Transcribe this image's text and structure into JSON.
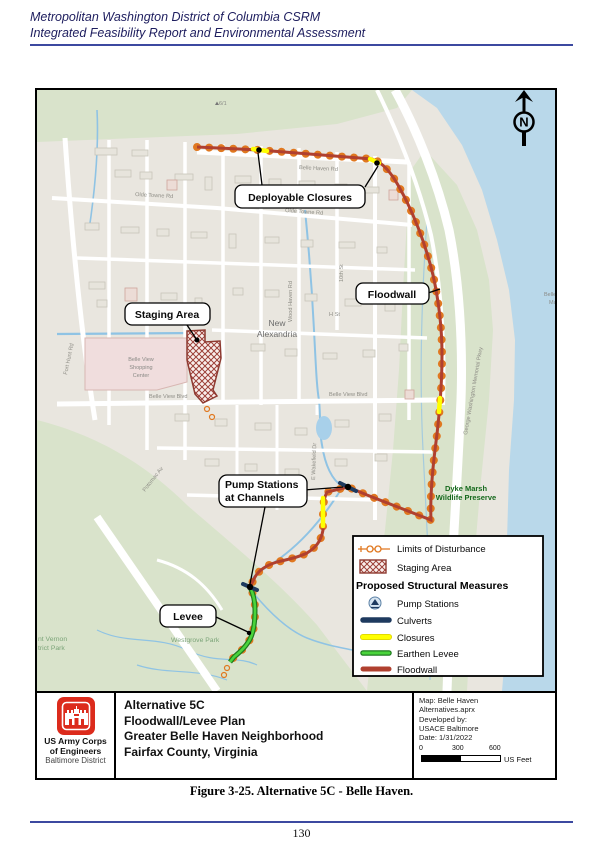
{
  "header": {
    "line1": "Metropolitan Washington District of Columbia CSRM",
    "line2": "Integrated Feasibility Report and Environmental Assessment"
  },
  "map": {
    "north_letter": "N",
    "spot_marker": "6/1",
    "callout_deployable": "Deployable Closures",
    "callout_floodwall": "Floodwall",
    "callout_staging": "Staging Area",
    "callout_pump_line1": "Pump Stations",
    "callout_pump_line2": "at Channels",
    "callout_levee": "Levee",
    "place_new": "New",
    "place_alexandria": "Alexandria",
    "place_shopping_l1": "Belle View",
    "place_shopping_l2": "Shopping",
    "place_shopping_l3": "Center",
    "place_dyke_l1": "Dyke Marsh",
    "place_dyke_l2": "Wildlife Preserve",
    "place_westgrove": "Westgrove Park",
    "place_mtvernon_l1": "nt Vernon",
    "place_mtvernon_l2": "trict Park",
    "place_marina_l1": "Belle",
    "place_marina_l2": "Ma",
    "st_belle_haven": "Belle Haven Rd",
    "st_olde_towne_w": "Olde Towne Rd",
    "st_olde_towne_e": "Olde Towne Rd",
    "st_belle_view_w": "Belle View Blvd",
    "st_belle_view_e": "Belle View Blvd",
    "st_fort_hunt": "Fort Hunt Rd",
    "st_gw_pkwy": "George Washington Memorial Pkwy",
    "st_wood_haven": "Wood Haven Rd",
    "st_10th": "10th St",
    "st_7th": "7th St",
    "st_h": "H St",
    "st_wakefield": "E Wakefield Dr",
    "st_potomac": "Potomac Av"
  },
  "legend": {
    "lod": "Limits of Disturbance",
    "staging": "Staging Area",
    "group_title": "Proposed Structural Measures",
    "pump": "Pump Stations",
    "culverts": "Culverts",
    "closures": "Closures",
    "levee": "Earthen Levee",
    "floodwall": "Floodwall"
  },
  "title_block": {
    "org_line1": "US Army Corps",
    "org_line2": "of Engineers",
    "org_line3": "Baltimore District",
    "title_line1": "Alternative 5C",
    "title_line2": "Floodwall/Levee Plan",
    "title_line3": "Greater Belle Haven Neighborhood",
    "title_line4": "Fairfax County, Virginia",
    "meta_line1": "Map: Belle Haven",
    "meta_line2": "Alternatives.aprx",
    "meta_line3": "Developed by:",
    "meta_line4": "USACE Baltimore",
    "meta_line5": "Date: 1/31/2022",
    "scale_0": "0",
    "scale_300": "300",
    "scale_600": "600",
    "scale_unit": "US Feet"
  },
  "caption": "Figure 3-25. Alternative 5C - Belle Haven.",
  "footer_page": "130",
  "colors": {
    "floodwall": "#b0402f",
    "earthen_levee": "#4ad43b",
    "closures": "#ffff00",
    "culverts": "#1e3a5f",
    "limits_of_disturbance": "#e07820",
    "staging_area": "#8e3a31",
    "water": "#b9d8ea",
    "park_green": "#d9e3cb",
    "usace_red": "#dc2b1c"
  }
}
